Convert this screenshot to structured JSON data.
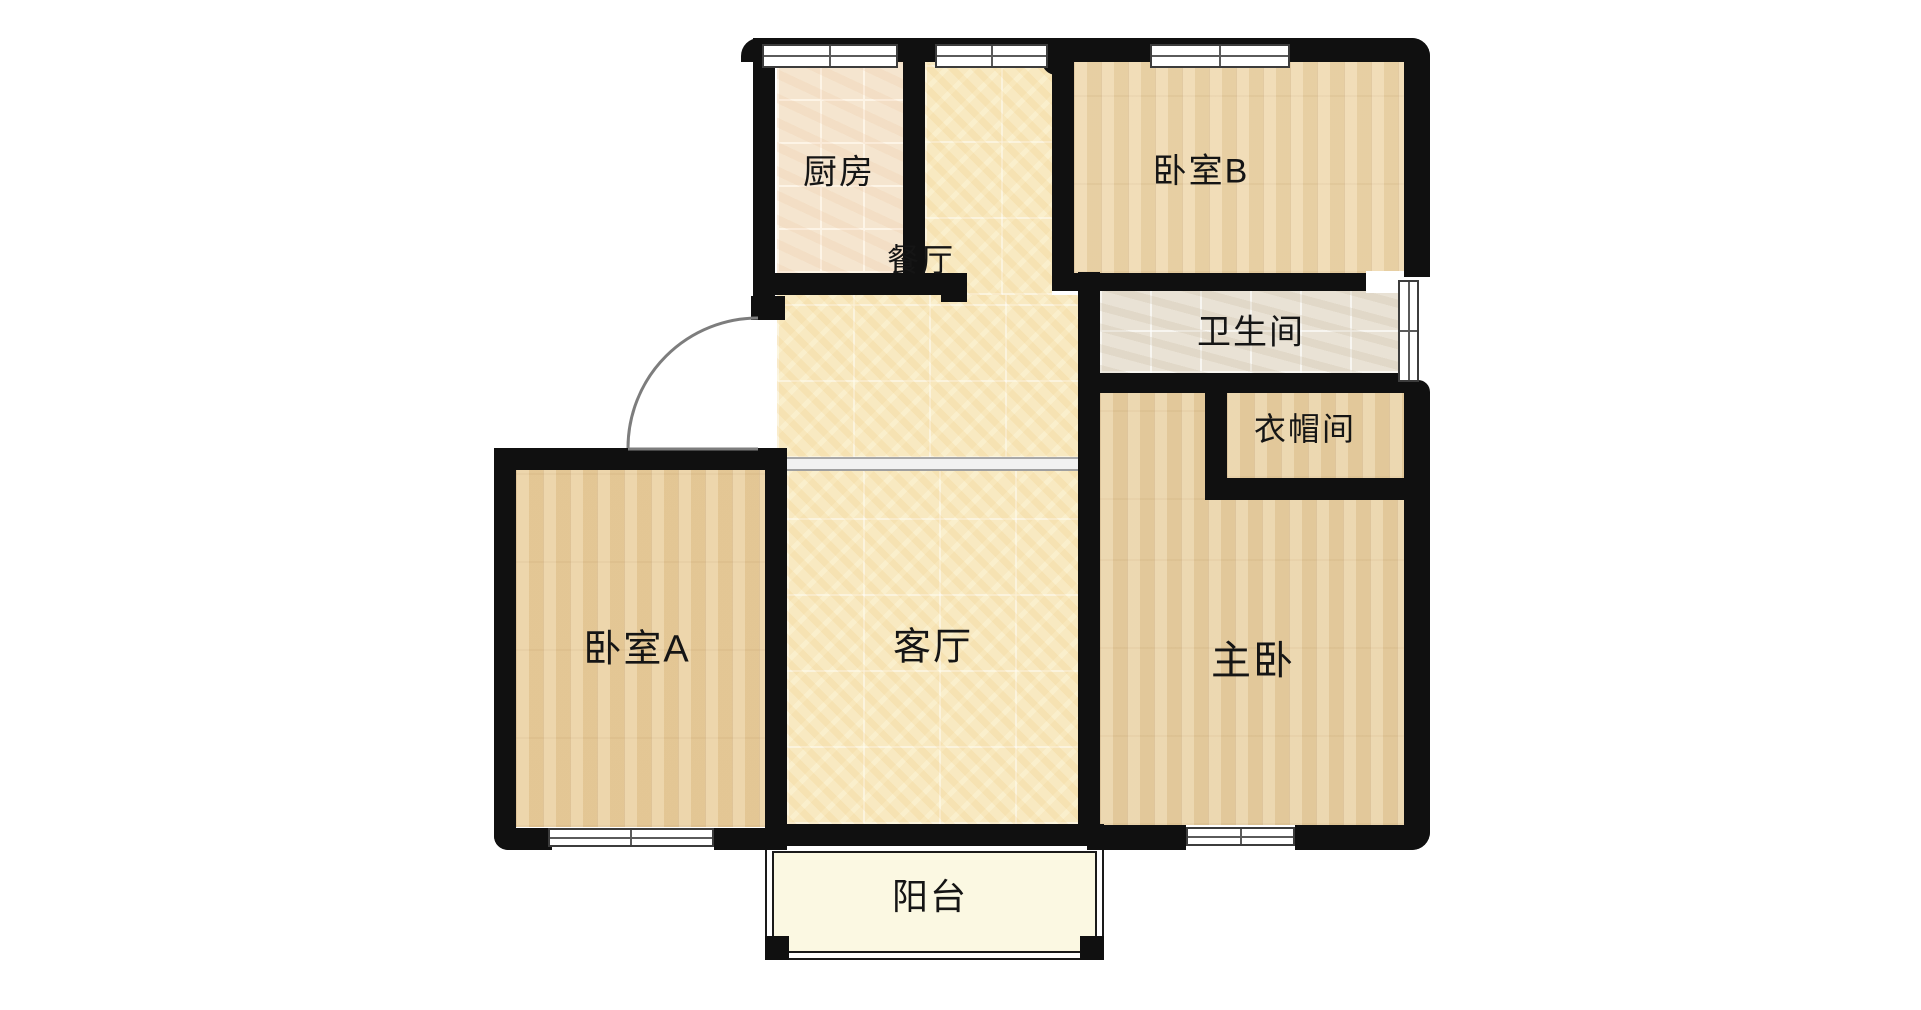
{
  "floorplan": {
    "title": "apartment-floor-plan",
    "rooms": [
      {
        "id": "kitchen",
        "label": "厨房",
        "floor": "kitchen-tile"
      },
      {
        "id": "dining",
        "label": "餐厅",
        "floor": "warm-tile"
      },
      {
        "id": "bedroom-b",
        "label": "卧室B",
        "floor": "wood"
      },
      {
        "id": "bathroom",
        "label": "卫生间",
        "floor": "bath-tile"
      },
      {
        "id": "cloakroom",
        "label": "衣帽间",
        "floor": "wood"
      },
      {
        "id": "master-bedroom",
        "label": "主卧",
        "floor": "wood"
      },
      {
        "id": "bedroom-a",
        "label": "卧室A",
        "floor": "wood"
      },
      {
        "id": "living-room",
        "label": "客厅",
        "floor": "warm-tile"
      },
      {
        "id": "balcony",
        "label": "阳台",
        "floor": "balcony"
      }
    ],
    "colors": {
      "wall": "#101010",
      "wood_floor": "#eace9c",
      "warm_tile": "#f8e9c1",
      "kitchen_tile": "#f5e5cf",
      "bath_tile": "#e9e2d5",
      "balcony_floor": "#fbf8e2",
      "window_frame": "#3c3c3c",
      "door_arc": "#7d7d7d",
      "label_text": "#151515",
      "background": "#ffffff"
    }
  }
}
